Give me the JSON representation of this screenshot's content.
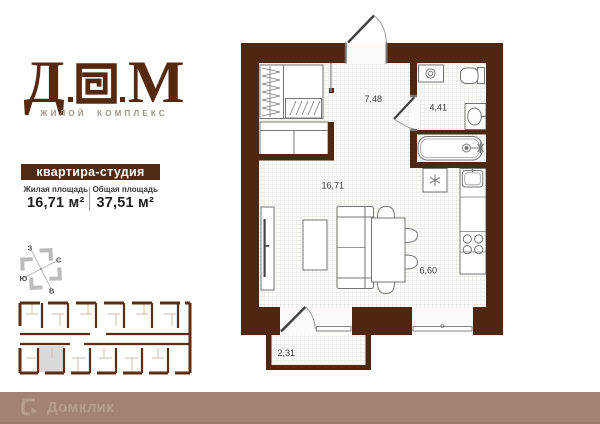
{
  "brand": {
    "letter_d": "Д",
    "letter_m": "М",
    "tagline": "ЖИЛОЙ КОМПЛЕКС"
  },
  "apartment": {
    "type": "квартира-студия",
    "living": {
      "label": "Жилая площадь",
      "value": "16,71 м²"
    },
    "total": {
      "label": "Общая площадь",
      "value": "37,51 м²"
    }
  },
  "plan": {
    "areas": {
      "hall": "7,48",
      "bath": "4,41",
      "living": "16,71",
      "kitchen": "6,60",
      "balcony": "2,31"
    }
  },
  "compass": {
    "n": "С",
    "s": "Ю",
    "w": "З",
    "e": "В"
  },
  "footer": {
    "brand": "Домклик"
  },
  "colors": {
    "wall": "#4f2711",
    "accent_bar": "#4f2a11",
    "footer_bg": "#a08471",
    "footer_fg": "#b79e8a",
    "highlight_unit": "#dadada"
  }
}
